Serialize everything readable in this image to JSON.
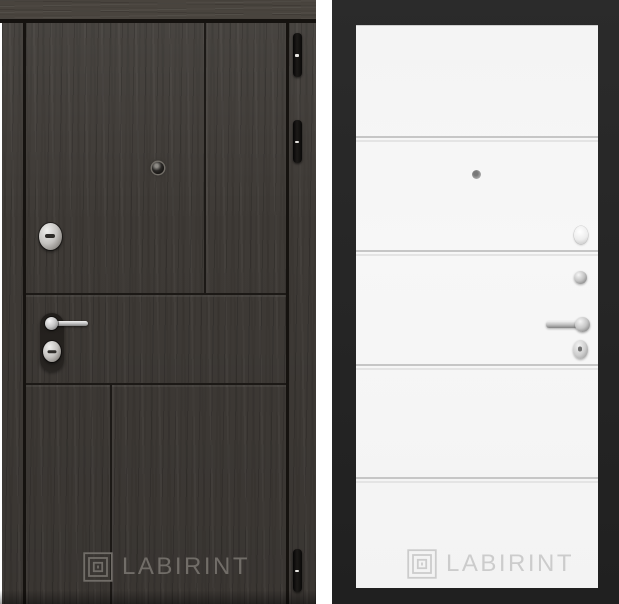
{
  "page": {
    "background": "#ffffff"
  },
  "theme": {
    "page_bg": "#ffffff",
    "wood_base": "#3e3a36",
    "wood_light": "#49443e",
    "wood_dark_line": "#15120f",
    "frame_black": "#202020",
    "panel_white": "#f7f7f7",
    "groove_dark": "#c6c6c6",
    "groove_light": "#e4e4e4",
    "logo_left": "#716d68",
    "logo_right": "#cccccc"
  },
  "doors": {
    "left": {
      "brand_label": "LABIRINT",
      "logo_icon": "labirint-maze-icon",
      "hardware": [
        "peephole",
        "security-lock-cylinder",
        "lever-handle",
        "lock-cylinder",
        "door-hinge",
        "door-hinge",
        "door-hinge"
      ]
    },
    "right": {
      "brand_label": "LABIRINT",
      "logo_icon": "labirint-maze-icon",
      "hardware": [
        "peephole",
        "thumbturn-knob",
        "night-latch-knob",
        "lever-handle",
        "lock-cylinder"
      ]
    }
  }
}
